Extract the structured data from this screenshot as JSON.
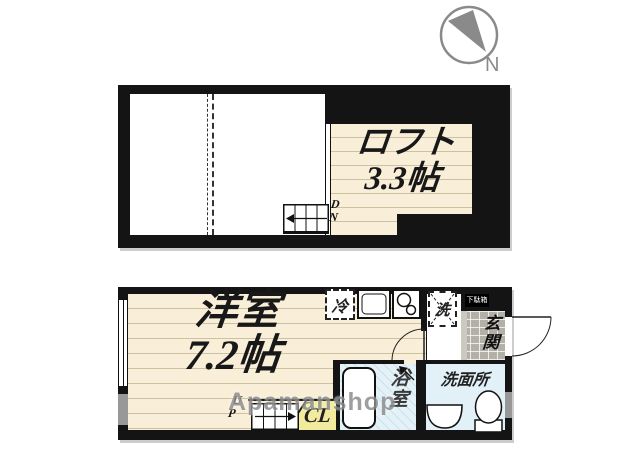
{
  "compass": {
    "label": "N"
  },
  "upper_floor": {
    "loft_label_line1": "ロフト",
    "loft_label_line2": "3.3帖",
    "dn_top": "D",
    "dn_bottom": "N"
  },
  "lower_floor": {
    "room_label_line1": "洋室",
    "room_label_line2": "7.2帖",
    "fridge_label": "冷",
    "washer_label": "洗",
    "shoebox_label": "下駄箱",
    "entrance_label": "玄関",
    "bath_label": "浴室",
    "washroom_label": "洗面所",
    "closet_label": "CL",
    "up_top": "U",
    "up_bottom": "P"
  },
  "watermark": {
    "text": "Apamanshop"
  },
  "colors": {
    "wall": "#141414",
    "floor_cream": "#f9efd9",
    "stripe": "#ccc1a3",
    "bath_blue": "#e4f2f8",
    "closet_yellow": "#f2eb9e",
    "tile_gray": "#b3b0a8",
    "compass_gray": "#8a8a8a"
  }
}
